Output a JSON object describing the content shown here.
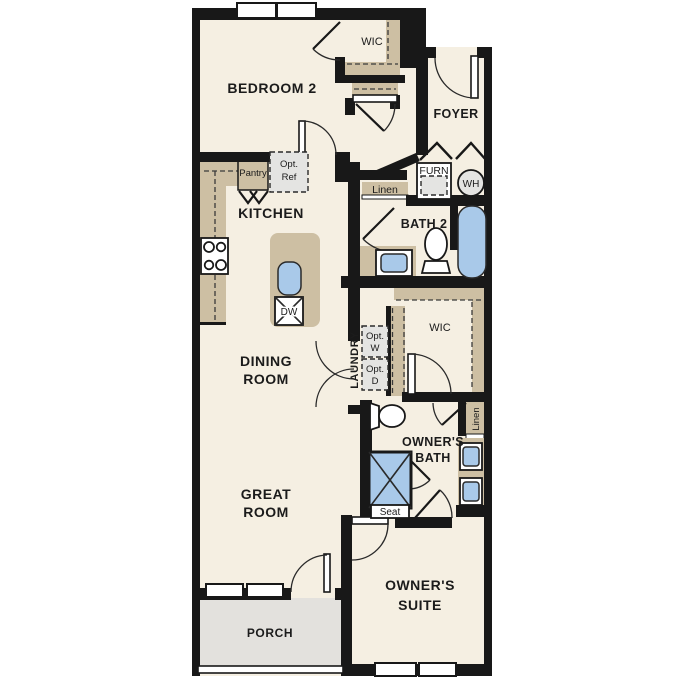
{
  "plan": {
    "rooms": {
      "bedroom2": "BEDROOM 2",
      "wic_bedroom": "WIC",
      "foyer": "FOYER",
      "kitchen": "KITCHEN",
      "dining1": "DINING",
      "dining2": "ROOM",
      "bath2": "BATH 2",
      "laundry": "LAUNDRY",
      "wic_owners": "WIC",
      "obath1": "OWNER'S",
      "obath2": "BATH",
      "great1": "GREAT",
      "great2": "ROOM",
      "suite1": "OWNER'S",
      "suite2": "SUITE",
      "porch": "PORCH"
    },
    "features": {
      "pantry": "Pantry",
      "optref1": "Opt.",
      "optref2": "Ref",
      "linen_hall": "Linen",
      "furnace": "FURN",
      "water_heater": "WH",
      "dishwasher": "DW",
      "optw1": "Opt.",
      "optw2": "W",
      "optd1": "Opt.",
      "optd2": "D",
      "linen_owners": "Linen",
      "shower_seat": "Seat"
    },
    "colors": {
      "wall": "#181818",
      "floor": "#f5efe2",
      "casework_tan": "#cdbfa3",
      "fixture_blue": "#a9c9e9",
      "appliance_gray": "#e4e4e2",
      "porch_gray": "#e3e1dd",
      "background": "#ffffff"
    }
  }
}
